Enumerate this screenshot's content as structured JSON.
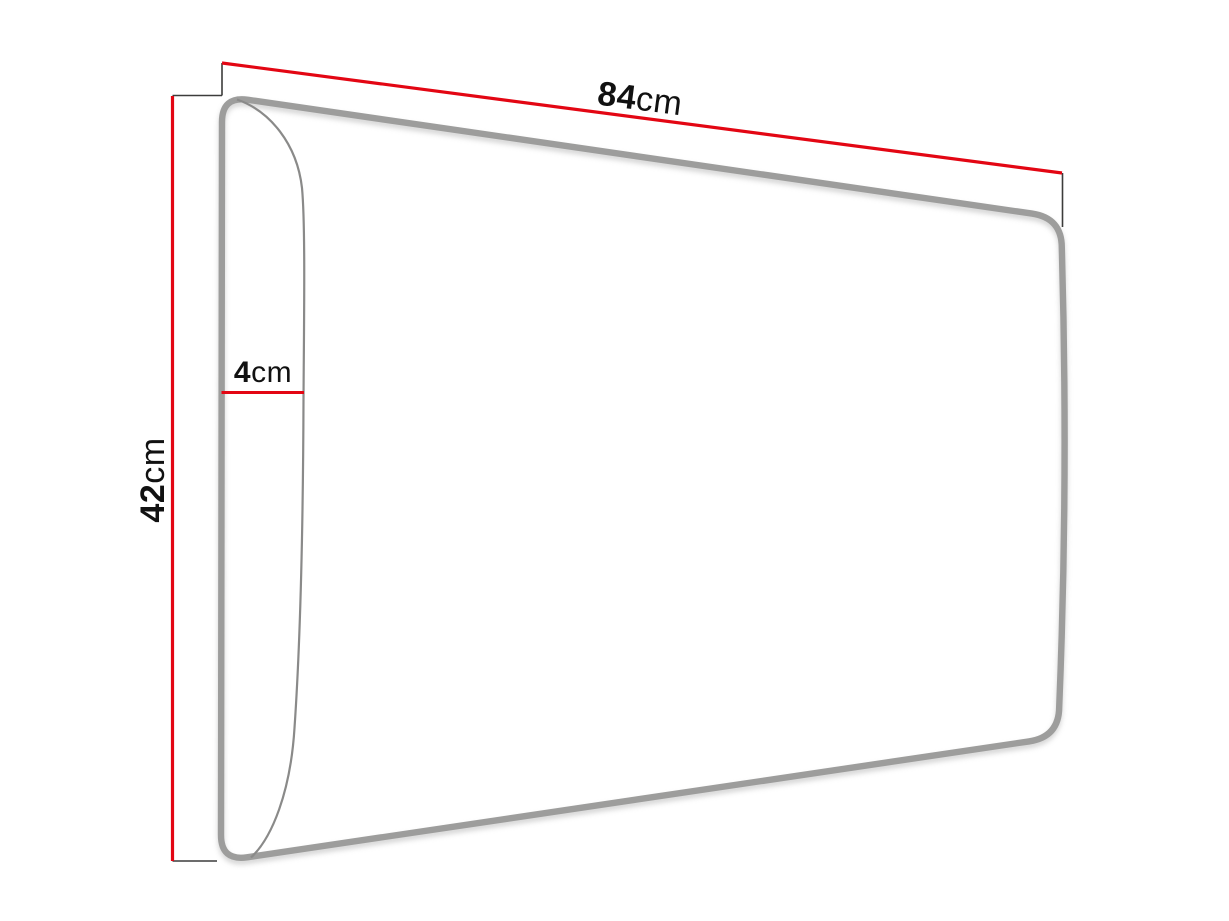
{
  "diagram": {
    "subject": "upholstered-wall-panel-dimension-drawing",
    "dimensions": {
      "width": {
        "value": "84",
        "unit": "cm"
      },
      "height": {
        "value": "42",
        "unit": "cm"
      },
      "depth": {
        "value": "4",
        "unit": "cm"
      }
    },
    "colors": {
      "dimension_line": "#e30613",
      "extension_line": "#3c3c3b",
      "panel_outline": "#9d9d9c",
      "panel_front_edge": "#8a8a89",
      "panel_fill": "#ffffff",
      "label_text": "#111111",
      "background": "#ffffff"
    }
  }
}
